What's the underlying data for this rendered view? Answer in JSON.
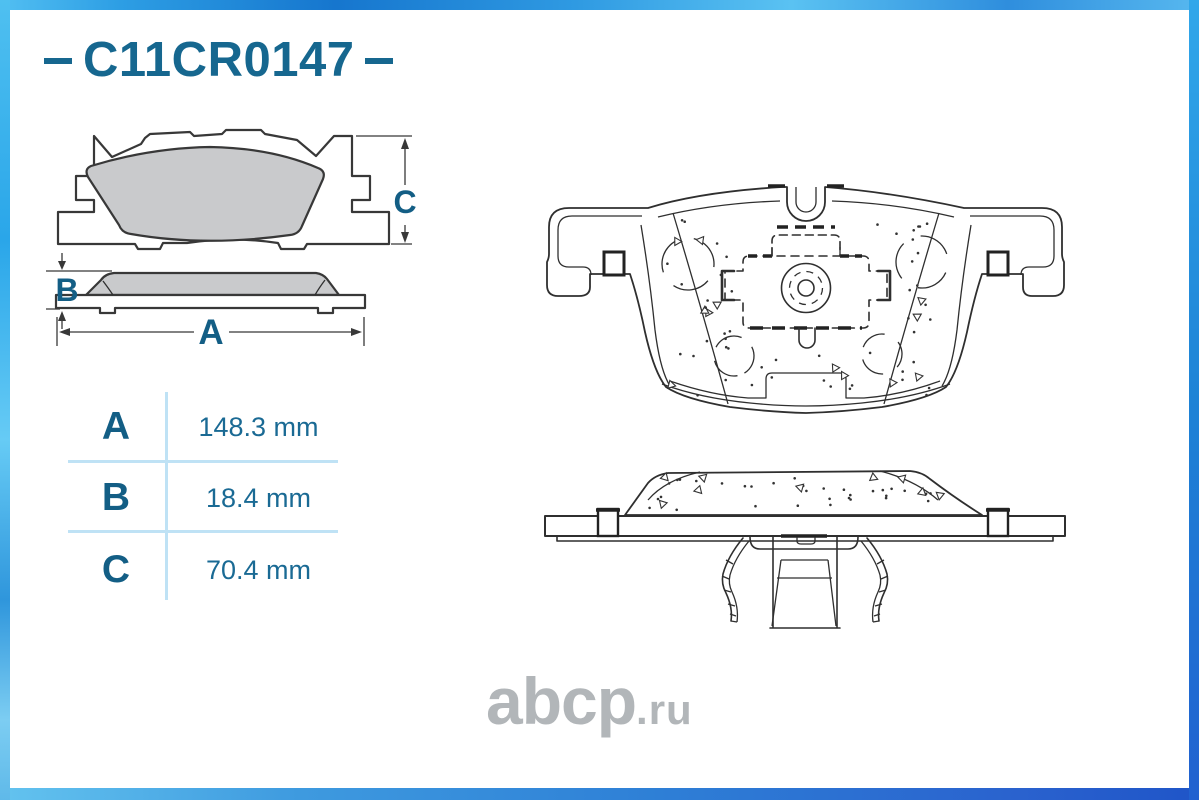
{
  "header": {
    "part_number": "C11CR0147"
  },
  "dimensions_table": {
    "rows": [
      {
        "label": "A",
        "value": "148.3 mm"
      },
      {
        "label": "B",
        "value": "18.4 mm"
      },
      {
        "label": "C",
        "value": "70.4 mm"
      }
    ]
  },
  "drawings": {
    "front_view": {
      "dim_label": "C"
    },
    "profile_view": {
      "dim_label_b": "B",
      "dim_label_a": "A"
    }
  },
  "watermark": {
    "name": "abcp",
    "tld": ".ru"
  },
  "colors": {
    "accent_teal": "#16678f",
    "table_letter": "#135e85",
    "table_value": "#1a6a94",
    "table_line": "#bfe2f5",
    "pad_fill": "#c9cacc",
    "drawing_stroke": "#2f2f2f",
    "watermark_gray": "#b2b6b9",
    "border_blue_light": "#5ac2f2",
    "border_blue_dark": "#2a62ce"
  }
}
